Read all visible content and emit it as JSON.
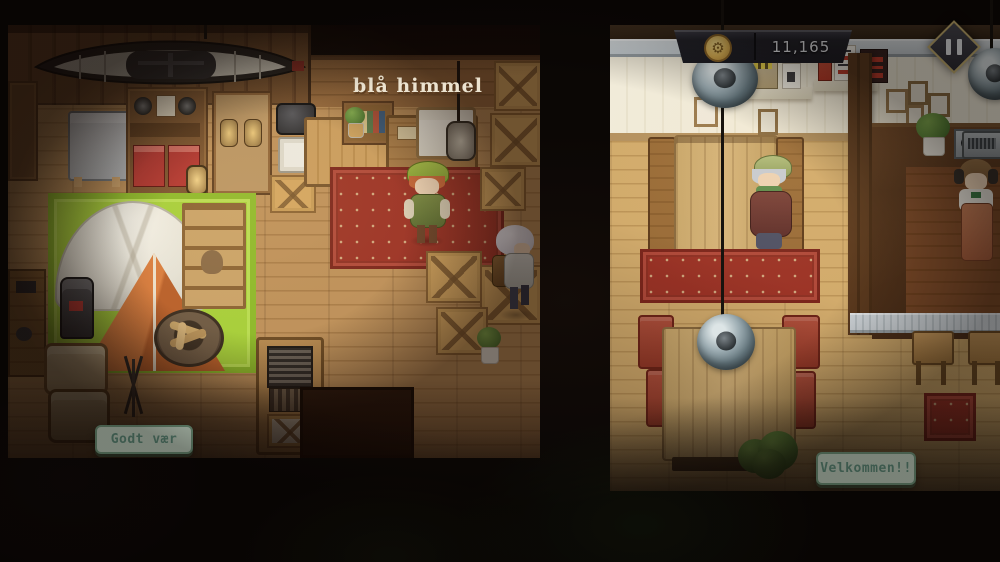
{
  "hud": {
    "balance": "11,165",
    "balance_icon": "coin-icon",
    "pause_icon": "pause-icon"
  },
  "shop": {
    "floor_sign": "blå himmel",
    "tooltip": "Godt vær"
  },
  "cafe": {
    "tooltip": "Velkommen!!"
  },
  "colors": {
    "hud_banner": "#26262e",
    "hud_text": "#edeff2",
    "coin_gold": "#dcb254",
    "pause_border": "#c9b372",
    "tooltip_bg": "#d9edda",
    "tooltip_border": "#7ea98b",
    "tooltip_text": "#6ba18c",
    "floor_sign_color": "#ece3d0",
    "shop_floor": "#b78b52",
    "cafe_floor": "#cda668",
    "cafe_wall": "#f0ead8",
    "grass_mat": "#a6cf3a",
    "tent_orange": "#c96a33",
    "rug_red": "#9c3326"
  }
}
